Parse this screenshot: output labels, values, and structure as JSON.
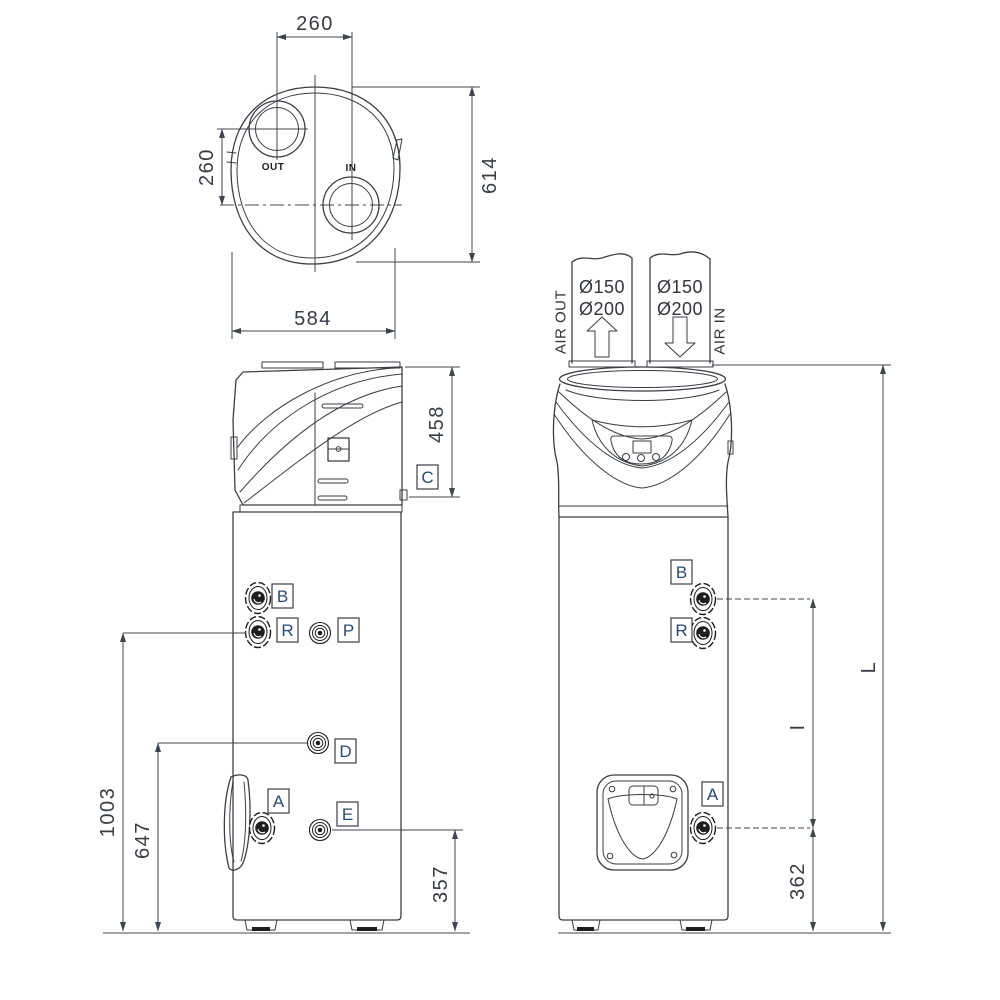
{
  "drawing": {
    "top_view": {
      "width_between_ports": "260",
      "height_between_ports": "260",
      "depth_overall": "614",
      "width_overall": "584",
      "port_out": "OUT",
      "port_in": "IN"
    },
    "side_view": {
      "head_height": "458",
      "height_r_connection": "1003",
      "height_d_connection": "647",
      "height_e_connection": "357",
      "fittings": {
        "c": "C",
        "b": "B",
        "r": "R",
        "p": "P",
        "d": "D",
        "a": "A",
        "e": "E"
      }
    },
    "front_view": {
      "duct_out": {
        "diameter_1": "Ø150",
        "diameter_2": "Ø200",
        "label": "AIR OUT"
      },
      "duct_in": {
        "diameter_1": "Ø150",
        "diameter_2": "Ø200",
        "label": "AIR IN"
      },
      "fittings": {
        "b": "B",
        "r": "R",
        "a": "A"
      },
      "total_height": "L",
      "connection_span": "I",
      "height_a_connection": "362"
    },
    "colors": {
      "line": "#3a3e45",
      "dim_text": "#383d44",
      "fitting_letter": "#2d4a6e",
      "dark_fill": "#1e1e1e",
      "bg": "#ffffff"
    }
  }
}
